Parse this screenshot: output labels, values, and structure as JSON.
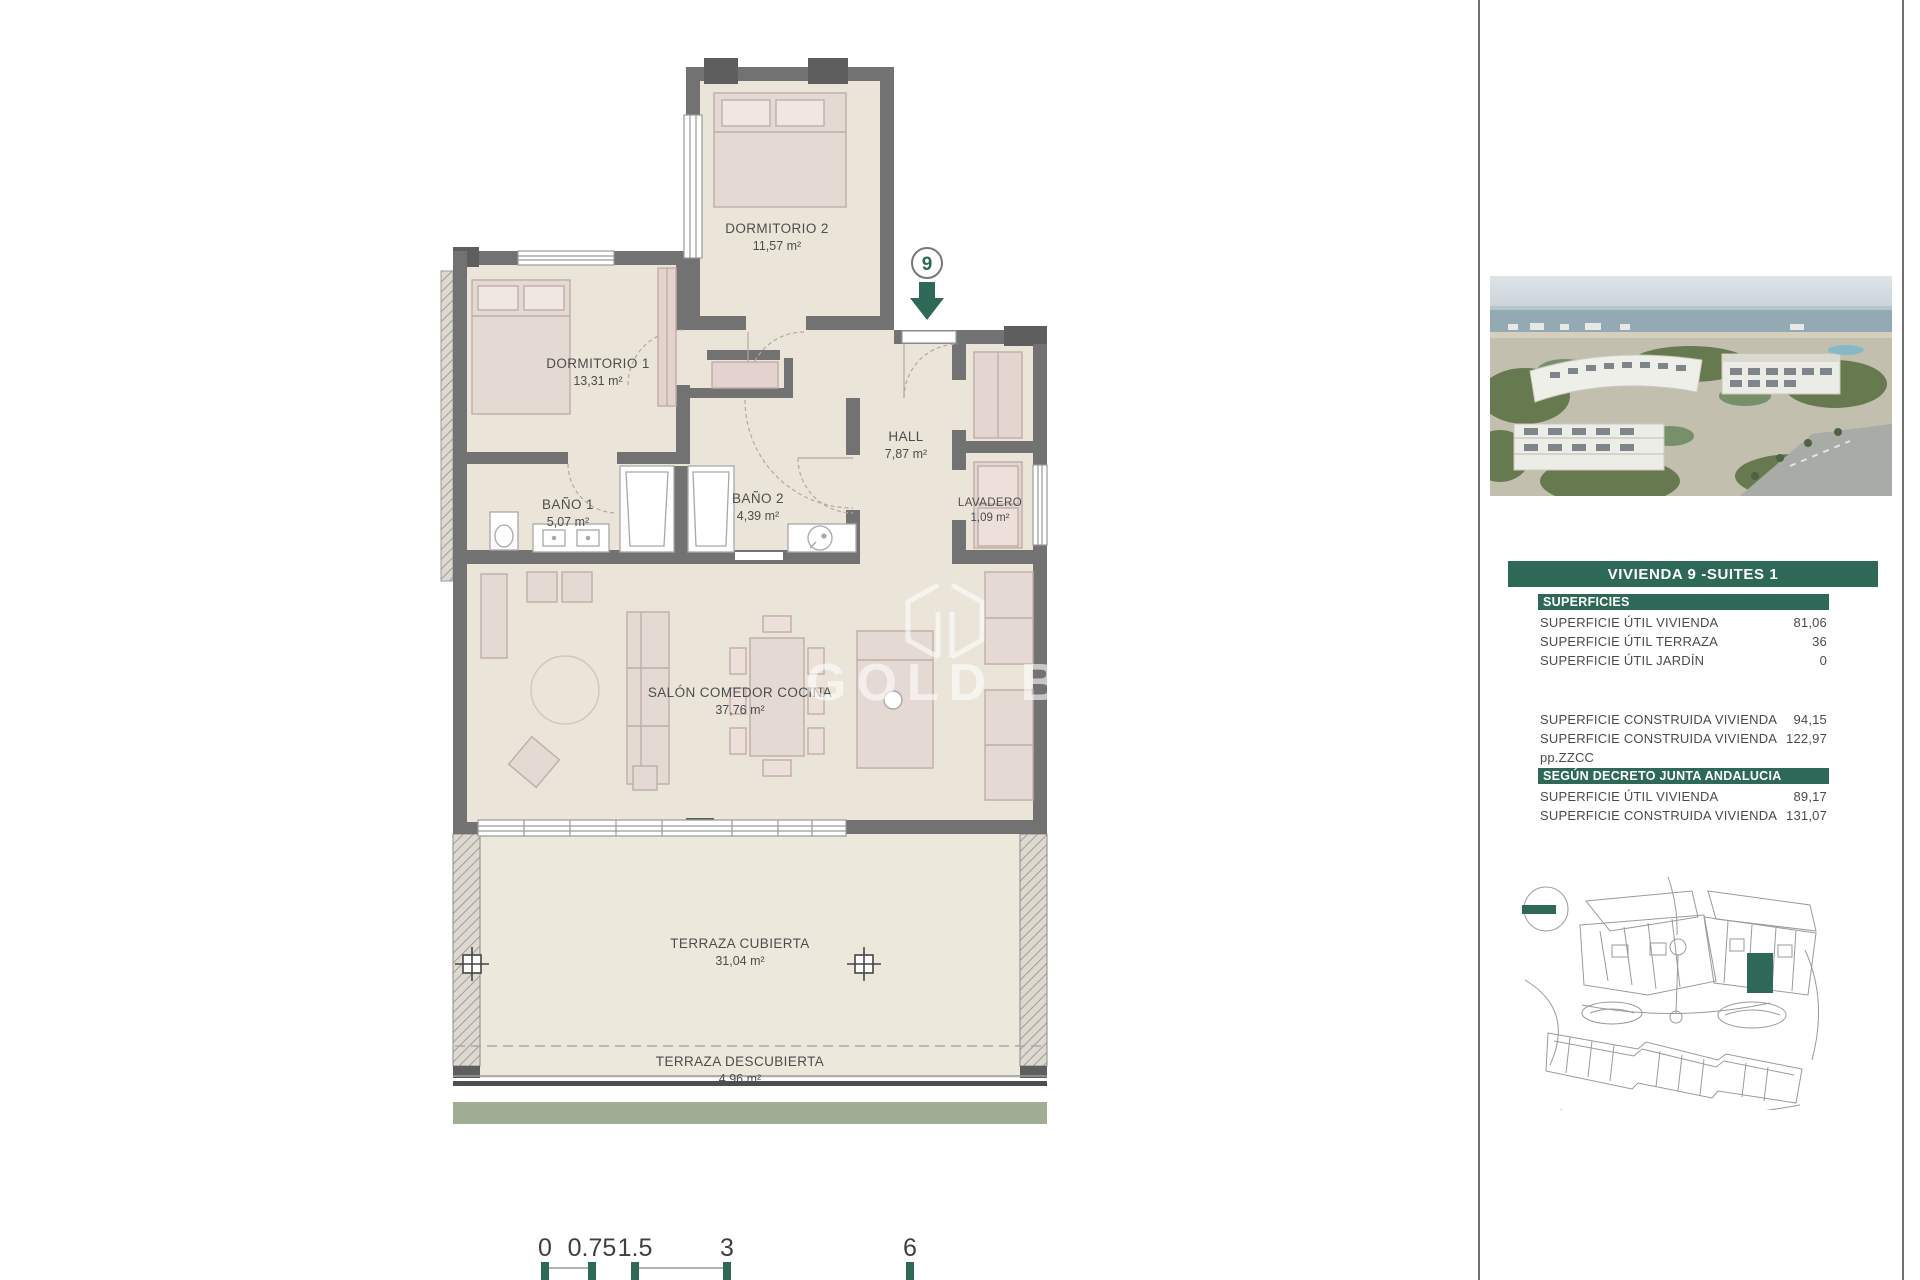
{
  "plan": {
    "marker": "9",
    "watermark": "GOLD BRIC",
    "rooms": [
      {
        "name": "DORMITORIO 2",
        "area": "11,57 m²"
      },
      {
        "name": "DORMITORIO 1",
        "area": "13,31 m²"
      },
      {
        "name": "BAÑO 1",
        "area": "5,07 m²"
      },
      {
        "name": "BAÑO 2",
        "area": "4,39 m²"
      },
      {
        "name": "HALL",
        "area": "7,87 m²"
      },
      {
        "name": "LAVADERO",
        "area": "1,09 m²"
      },
      {
        "name": "SALÓN COMEDOR COCINA",
        "area": "37,76 m²"
      },
      {
        "name": "TERRAZA CUBIERTA",
        "area": "31,04 m²"
      },
      {
        "name": "TERRAZA DESCUBIERTA",
        "area": "4,96 m²"
      }
    ],
    "scale": [
      "0",
      "0.75",
      "1.5",
      "3",
      "6"
    ]
  },
  "sidebar": {
    "title": "VIVIENDA 9 -SUITES 1",
    "sections": [
      {
        "header": "SUPERFICIES",
        "rows": [
          {
            "label": "SUPERFICIE ÚTIL VIVIENDA",
            "value": "81,06"
          },
          {
            "label": "SUPERFICIE ÚTIL TERRAZA",
            "value": "36"
          },
          {
            "label": "SUPERFICIE ÚTIL JARDÍN",
            "value": "0"
          }
        ]
      },
      {
        "header": "",
        "rows": [
          {
            "label": "SUPERFICIE CONSTRUIDA VIVIENDA",
            "value": "94,15"
          },
          {
            "label": "SUPERFICIE CONSTRUIDA VIVIENDA pp.ZZCC",
            "value": "122,97"
          }
        ]
      },
      {
        "header": "SEGÚN DECRETO JUNTA ANDALUCIA",
        "rows": [
          {
            "label": "SUPERFICIE ÚTIL VIVIENDA",
            "value": "89,17"
          },
          {
            "label": "SUPERFICIE CONSTRUIDA VIVIENDA",
            "value": "131,07"
          }
        ]
      }
    ]
  },
  "colors": {
    "accent_green": "#2E6957",
    "sage_strip": "#9FAE93",
    "wall_gray": "#727272"
  }
}
